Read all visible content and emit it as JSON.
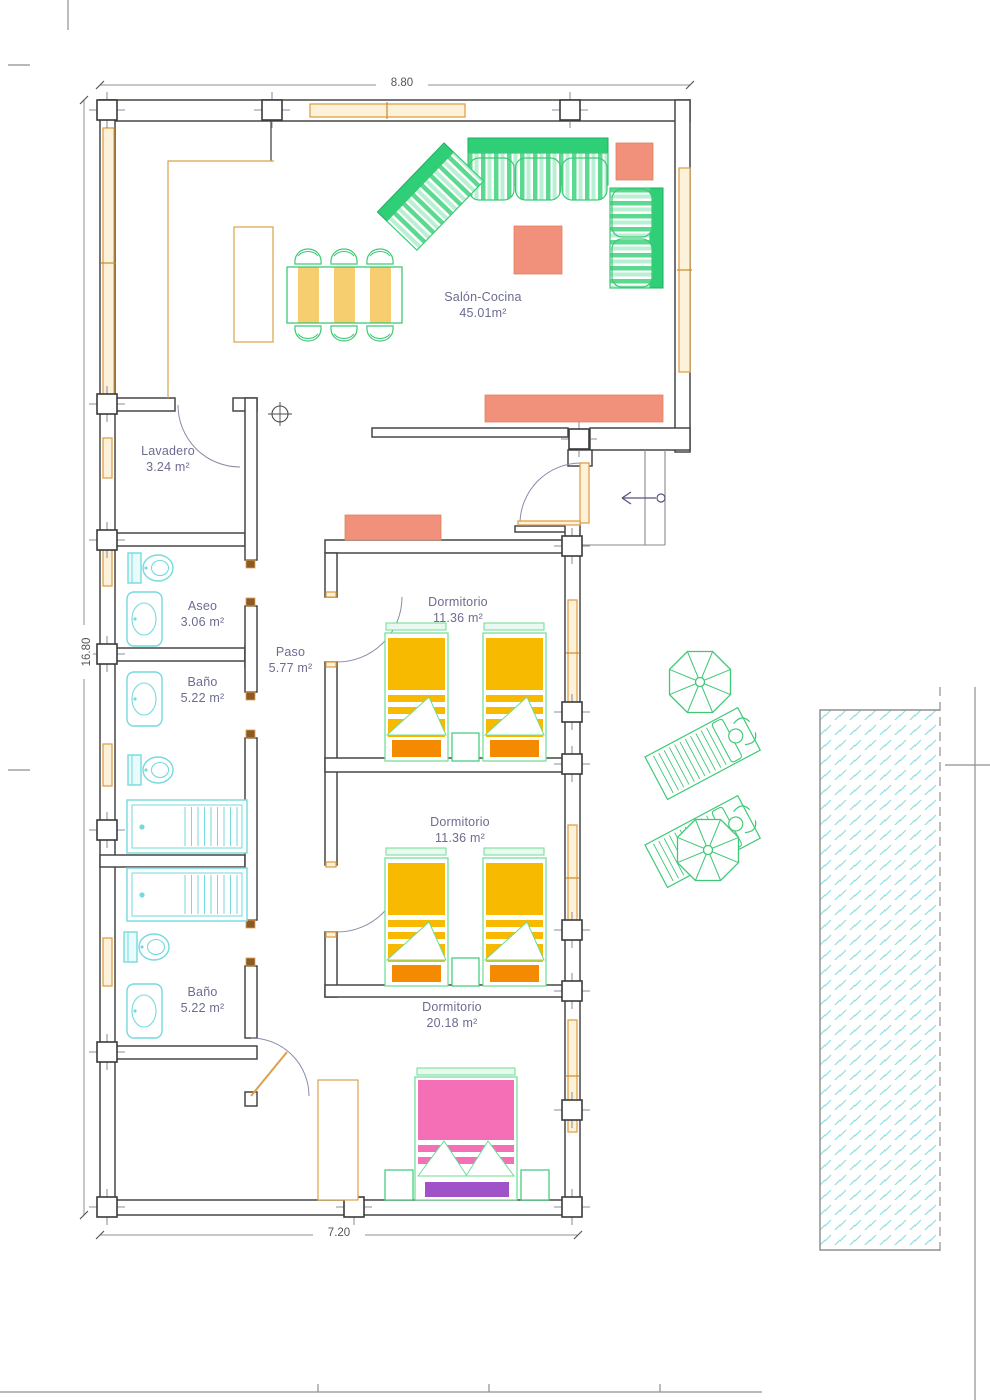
{
  "page": {
    "dim_top": "8.80",
    "dim_left": "16.80",
    "dim_bottom": "7.20"
  },
  "rooms": {
    "salon": {
      "name": "Salón-Cocina",
      "area": "45.01m²"
    },
    "lavadero": {
      "name": "Lavadero",
      "area": "3.24 m²"
    },
    "aseo": {
      "name": "Aseo",
      "area": "3.06 m²"
    },
    "paso": {
      "name": "Paso",
      "area": "5.77 m²"
    },
    "bano1": {
      "name": "Baño",
      "area": "5.22 m²"
    },
    "dorm1": {
      "name": "Dormitorio",
      "area": "11.36 m²"
    },
    "dorm2": {
      "name": "Dormitorio",
      "area": "11.36 m²"
    },
    "bano2": {
      "name": "Baño",
      "area": "5.22 m²"
    },
    "dorm3": {
      "name": "Dormitorio",
      "area": "20.18 m²"
    }
  },
  "symbols": {
    "entry_arrow": "arrow-left",
    "utility_mark": "circle-cross"
  },
  "colors": {
    "wall": "#474747",
    "window_orange": "#dfa04b",
    "furniture_green": "#3ec977",
    "sofa_dark_green": "#2fcf78",
    "accent_salmon": "#f2917b",
    "bed_yellow": "#f8ba00",
    "bed_orange": "#f38a00",
    "bed_pink": "#f46fb5",
    "bed_purple": "#a053c8",
    "fixture_cyan": "#74dadd",
    "label_text": "#6c6c91"
  }
}
